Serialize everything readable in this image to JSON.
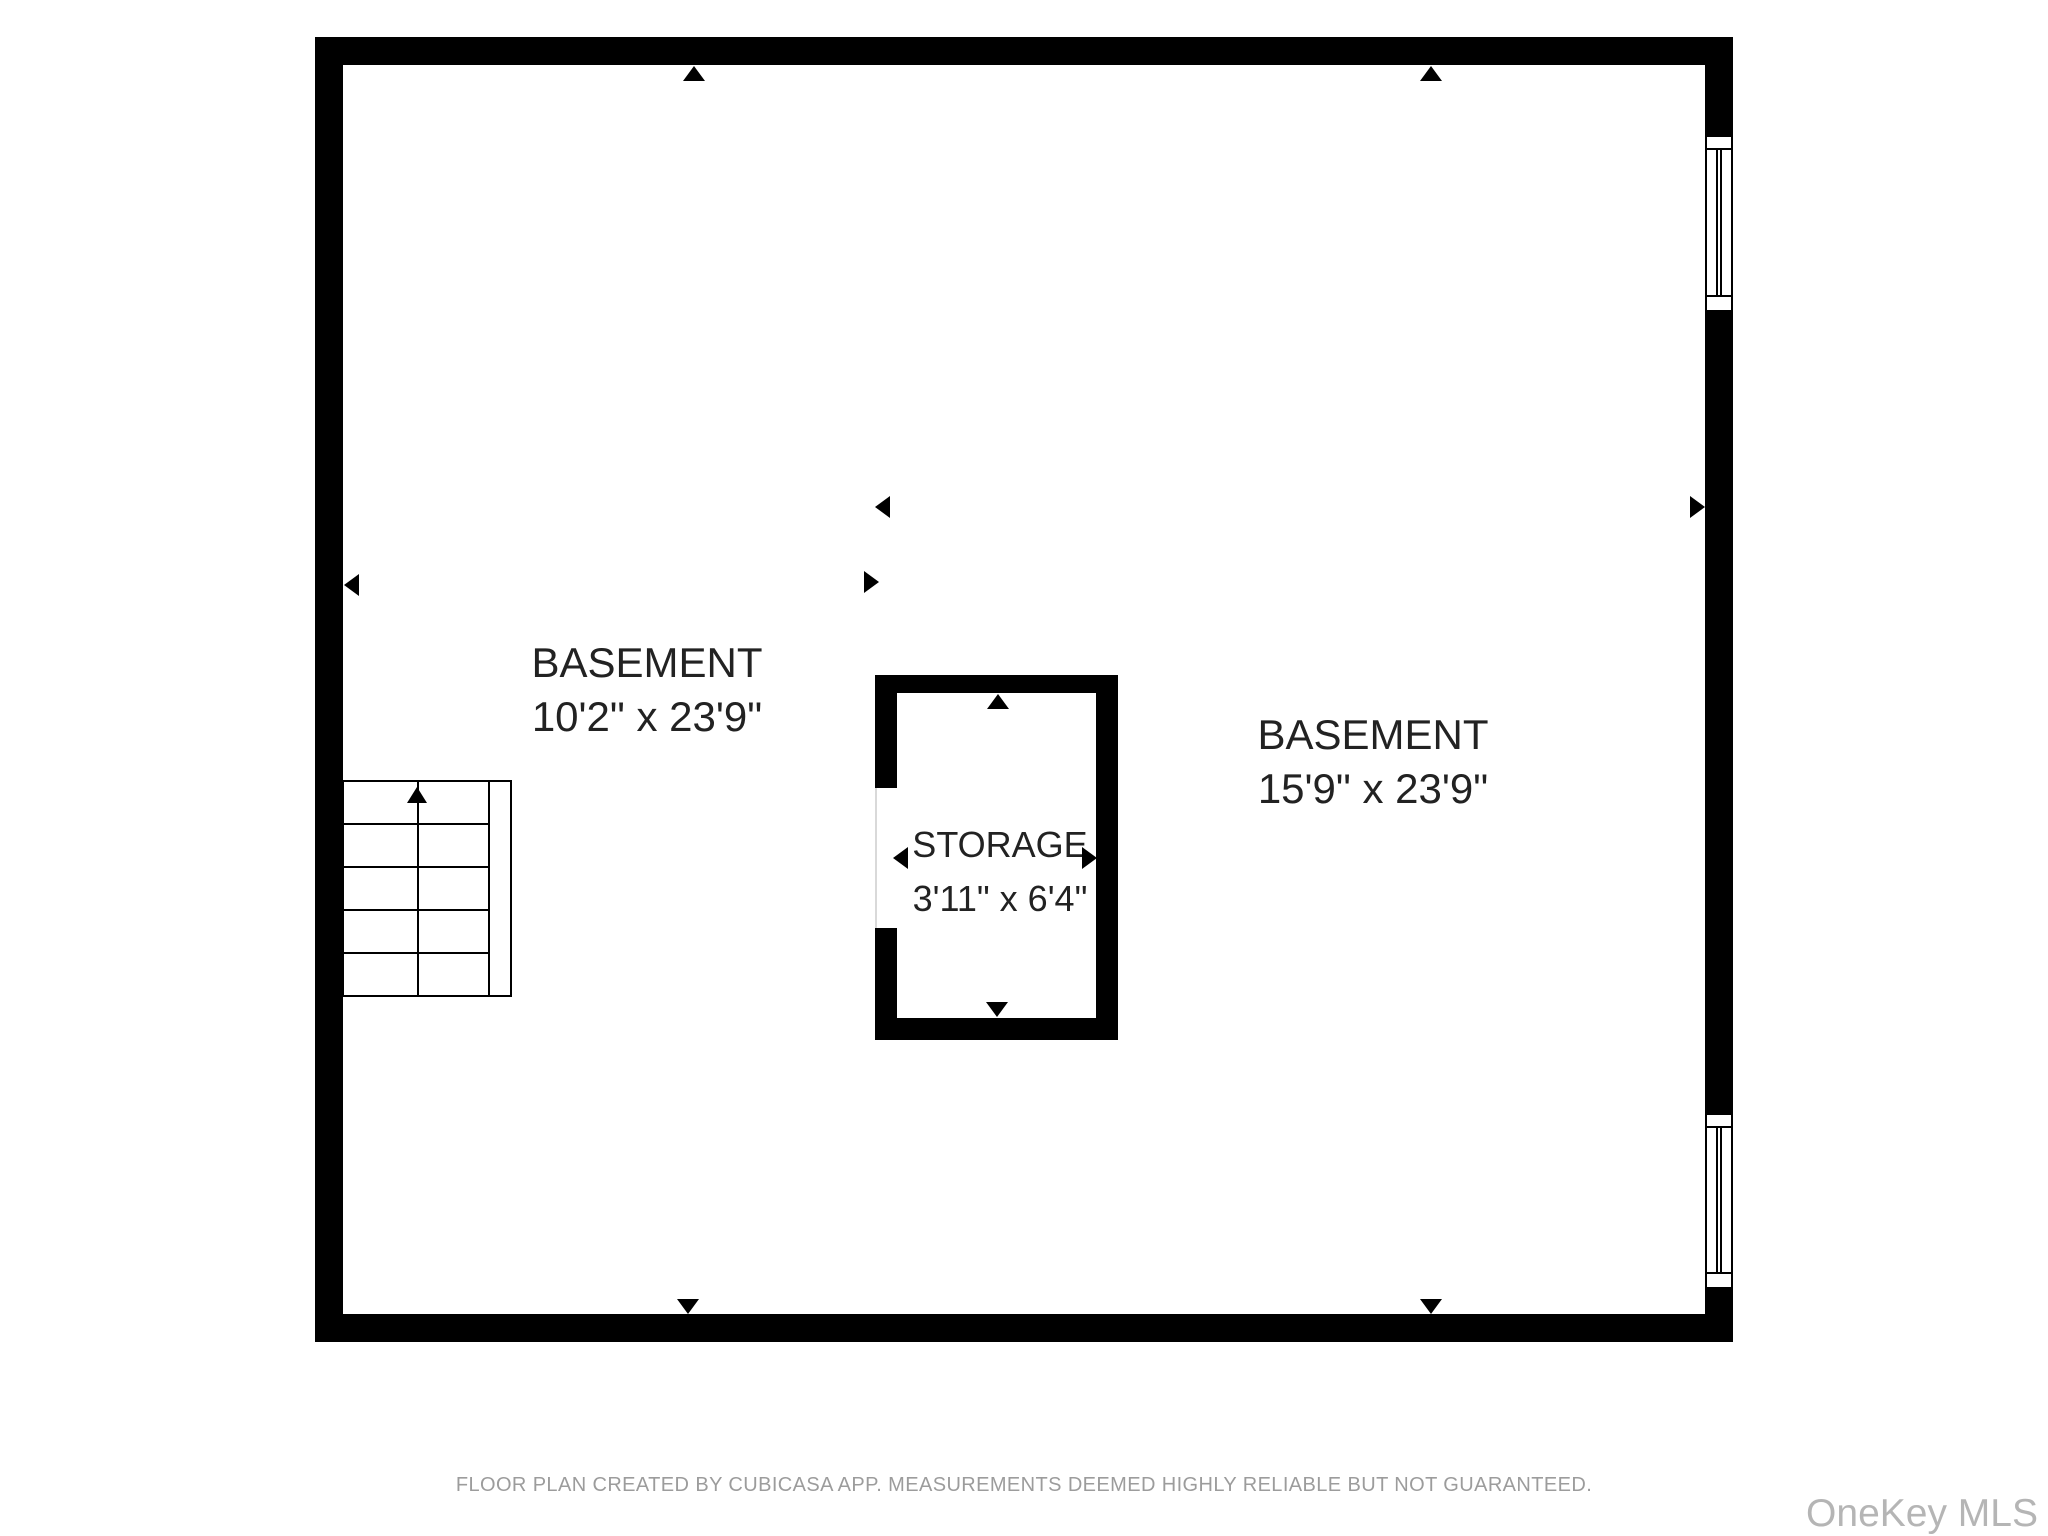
{
  "floor_plan": {
    "rooms": [
      {
        "name": "BASEMENT",
        "dimensions": "10'2\" x 23'9\""
      },
      {
        "name": "BASEMENT",
        "dimensions": "15'9\" x 23'9\""
      },
      {
        "name": "STORAGE",
        "dimensions": "3'11\" x 6'4\""
      }
    ],
    "features": [
      "staircase",
      "storage-room",
      "two-windows-right-wall"
    ],
    "icons": {
      "up-arrow": "▲",
      "down-arrow": "▼",
      "left-arrow": "◀",
      "right-arrow": "▶"
    }
  },
  "footer": {
    "disclaimer": "FLOOR PLAN CREATED BY CUBICASA APP. MEASUREMENTS DEEMED HIGHLY RELIABLE BUT NOT GUARANTEED."
  },
  "watermark": {
    "text": "OneKey MLS"
  },
  "colors": {
    "wall": "#000000",
    "background": "#ffffff",
    "disclaimer_text": "#9c9c9c",
    "watermark_text": "#b5b5b5",
    "label_text": "#222222"
  }
}
